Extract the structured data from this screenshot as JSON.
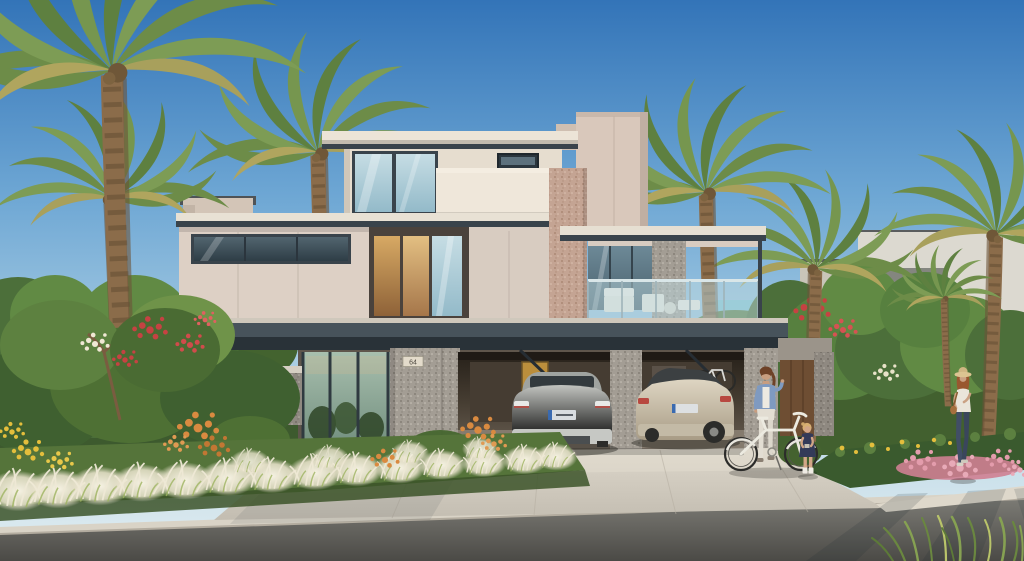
{
  "scene": {
    "description": "Sunlit modern two-storey villa with palm trees, two parked SUVs in an open garage, and people on the driveway",
    "house_number": "64",
    "objects": [
      "sky",
      "background-trees",
      "neighbor-villa-left",
      "neighbor-villa-right",
      "palm-trees",
      "main-villa",
      "balcony",
      "glass-railing",
      "outdoor-furniture",
      "garage",
      "grey-suv",
      "champagne-suv",
      "wall-mounted-bicycle",
      "entrance",
      "house-number-plaque",
      "garden",
      "white-ornamental-grasses",
      "red-flower-bush",
      "orange-flowers",
      "pink-flowers",
      "yellow-flowers",
      "driveway",
      "road",
      "sidewalk",
      "woman-with-bicycle",
      "bicycle",
      "child",
      "woman-walking"
    ],
    "palette": {
      "sky_top": "#3374b8",
      "sky_horizon": "#e2edf0",
      "villa_cream": "#e6ddcf",
      "villa_beige_panel": "#ddd0c5",
      "fascia_dark": "#39434b",
      "stone_grey": "#a39d94",
      "stone_pink": "#c4a493",
      "glass_cool": "#c6dde4",
      "glass_warm": "#d7a964",
      "palm_green": "#6d8c48",
      "foliage_green": "#4c6f3a",
      "flower_red": "#c64242",
      "flower_orange": "#d98a40",
      "flower_pink": "#e39cac",
      "flower_yellow": "#e4be3c",
      "grass_white": "#f6f2e3",
      "driveway_concrete": "#d9d3c7",
      "road_asphalt": "#6f6e69",
      "car_grey": "#b6b8b4",
      "car_champagne": "#d6cdbb",
      "denim_blue": "#7f9ac0"
    }
  }
}
